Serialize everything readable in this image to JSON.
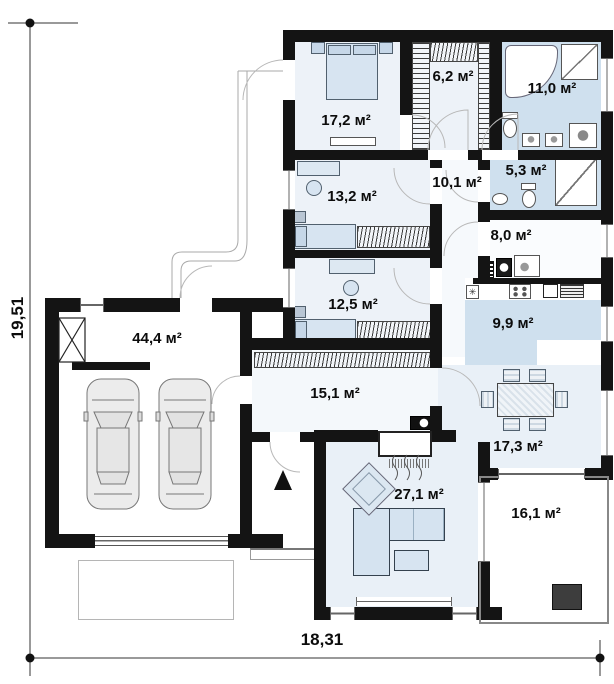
{
  "plan": {
    "dimensions": {
      "width": "18,31",
      "height": "19,51"
    },
    "rooms": {
      "bedroom_main": {
        "area": "17,2 м²"
      },
      "wardrobe": {
        "area": "6,2 м²"
      },
      "bathroom_main": {
        "area": "11,0 м²"
      },
      "bedroom_2": {
        "area": "13,2 м²"
      },
      "hallway": {
        "area": "10,1 м²"
      },
      "bathroom_2": {
        "area": "5,3 м²"
      },
      "utility": {
        "area": "8,0 м²"
      },
      "bedroom_3": {
        "area": "12,5 м²"
      },
      "kitchen": {
        "area": "9,9 м²"
      },
      "garage": {
        "area": "44,4 м²"
      },
      "corridor": {
        "area": "15,1 м²"
      },
      "dining": {
        "area": "17,3 м²"
      },
      "living_room": {
        "area": "27,1 м²"
      },
      "terrace": {
        "area": "16,1 м²"
      }
    },
    "colors": {
      "wall": "#141414",
      "wet_floor": "#cfe0ee",
      "room_floor": "#edf2f8",
      "open_floor": "#e9f0f7",
      "furniture": "#d7e4f1"
    },
    "furniture_icons": [
      "double-bed",
      "single-bed",
      "wardrobe-shelves",
      "desk",
      "chair",
      "corner-bathtub",
      "shower",
      "toilet",
      "sink",
      "washing-machine",
      "boiler",
      "kitchen-stove",
      "oven",
      "fridge",
      "dining-table",
      "corner-sofa",
      "coffee-table",
      "rug",
      "fireplace",
      "car",
      "entrance-arrow",
      "chimney-shaft"
    ]
  }
}
